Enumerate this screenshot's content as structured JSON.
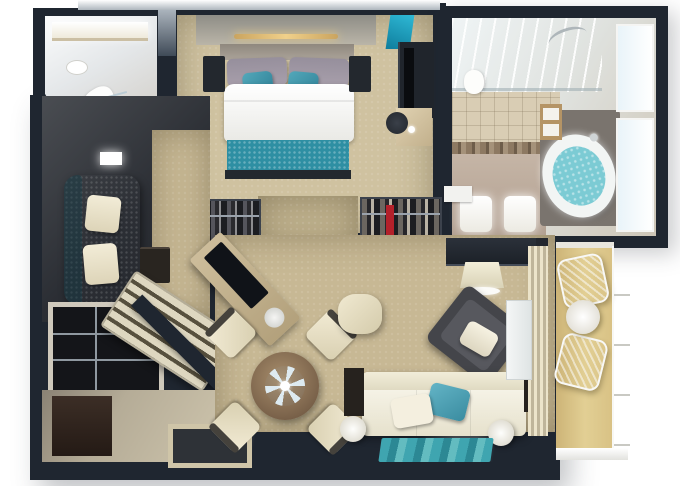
{
  "meta": {
    "description": "Photorealistic top-down 3D floor plan render of a one-bedroom suite with balcony",
    "width_px": 680,
    "height_px": 486,
    "visible_text": "none"
  },
  "colors": {
    "background": "#ffffff",
    "wall": "#1f2630",
    "wall_edge": "#39424e",
    "carpet": "#c7b894",
    "carpet_bedroom": "#cfc2a0",
    "carpet_doorway": "#bfb18d",
    "nook_floor": "#2f3237",
    "teal_sofa": "#3f8fa0",
    "teal_runner": "#2e8fa3",
    "teal_glass": "#2fb9d6",
    "teal_water": "#7ccbd4",
    "teal_rug": "#3fa5b0",
    "cream": "#efe8d2",
    "white_soft": "#f7f6f0",
    "gold_light": "#e9c878",
    "wood_table": "#8a6f52",
    "wood_cabinet": "#b59465",
    "glossy_floor": "#c9c0a6",
    "balcony_floor": "#d9c484",
    "tile": "#d9cdb4",
    "accent_tile": "#8d7962",
    "dark_furniture": "#23282e",
    "red_garment": "#b3202a"
  },
  "rooms": [
    {
      "id": "guest-bathroom",
      "name": "Guest bathroom",
      "items": [
        "lit vanity counter",
        "round sink",
        "toilet",
        "shower glass panel"
      ]
    },
    {
      "id": "bedroom",
      "name": "Bedroom",
      "items": [
        "king bed with white duvet",
        "teal bed runner",
        "grey pillows",
        "teal accent pillows",
        "gold ceiling light bar",
        "two nightstands",
        "wall art",
        "teal glass panel",
        "media console with TV",
        "vanity desk",
        "stool",
        "teal glass divider"
      ]
    },
    {
      "id": "main-bathroom",
      "name": "Master bathroom",
      "items": [
        "walk-in glass shower",
        "chrome fixtures",
        "beige tile floor",
        "mosaic accent band",
        "double sinks",
        "toilet",
        "white door",
        "oval bathtub with teal water",
        "wooden cabinet",
        "two windows"
      ]
    },
    {
      "id": "lounge-nook",
      "name": "Lounge nook",
      "items": [
        "teal chaise sofa",
        "two cream pillows",
        "dark side table",
        "wall light"
      ]
    },
    {
      "id": "closet",
      "name": "Closet / storage",
      "items": [
        "white shelving unit",
        "slatted luggage bench",
        "diagonal partition wall"
      ]
    },
    {
      "id": "entry-hall",
      "name": "Entry hall",
      "items": [
        "glossy stone floor",
        "dark rug",
        "sunken floor tray"
      ]
    },
    {
      "id": "living-room",
      "name": "Living room",
      "items": [
        "two open wardrobes with clothes",
        "red garment",
        "diagonal sideboard with TV",
        "champagne bucket",
        "round dining table",
        "flower centerpiece",
        "four cream dining chairs",
        "cream ottoman pouf",
        "wall desk",
        "shelf lamp",
        "dark armchair with white pillow",
        "white sofa",
        "teal pillow",
        "white pillow",
        "two dark end tables",
        "two white cylinder stools",
        "teal striped rug",
        "vertical blinds",
        "balcony door"
      ]
    },
    {
      "id": "balcony",
      "name": "Balcony",
      "items": [
        "gold decking",
        "two white wire chairs",
        "round white table",
        "white railing"
      ]
    }
  ]
}
